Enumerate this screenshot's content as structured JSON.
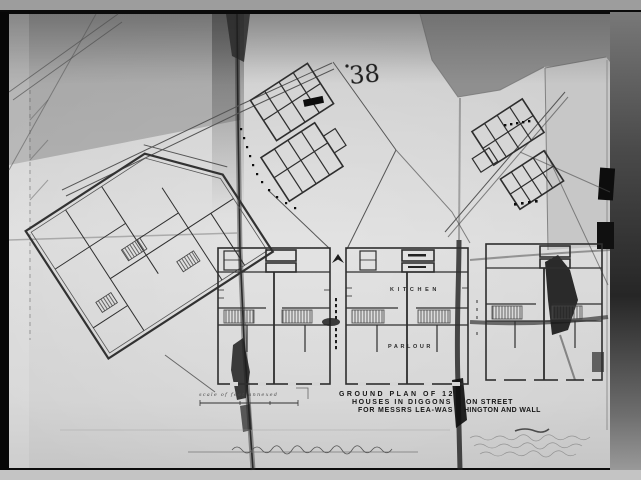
{
  "photo": {
    "catalog_number": "38",
    "title_block": {
      "line1": "GROUND PLAN OF 12",
      "line2_left": "HOUSES IN DIGGONS",
      "line2_right": "ON STREET",
      "line3_left": "FOR MESSRS LEA-WAS",
      "line3_right": "HINGTON AND WALL"
    },
    "scale_caption": "scale of feet annexed",
    "room_labels": {
      "kitchen": "KITCHEN",
      "parlour": "PARLOUR"
    },
    "colors": {
      "backing_gray": "#8f8f8f",
      "paper": "#d6d6d6",
      "ink": "#2e2e2e",
      "crease_dark": "#1c1c1c",
      "frame_black": "#070707"
    }
  }
}
